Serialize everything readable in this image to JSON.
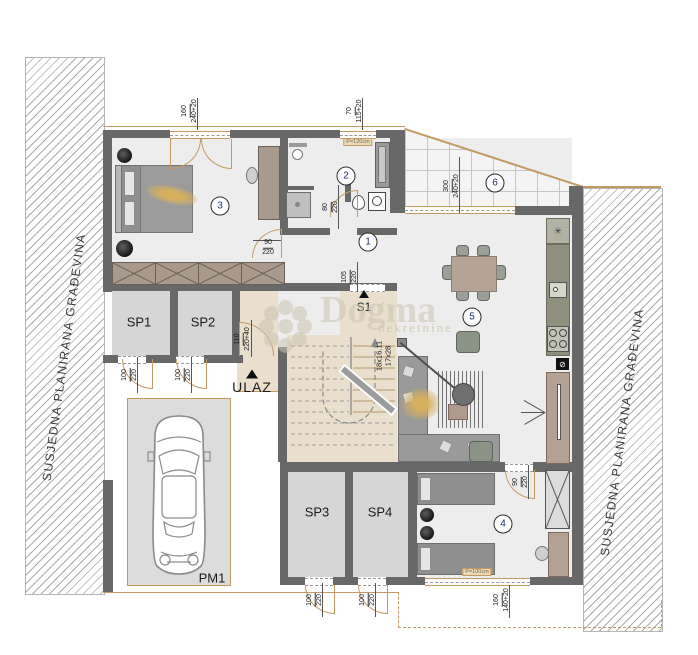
{
  "site": {
    "left_label": "SUSJEDNA PLANIRANA GRAĐEVINA",
    "right_label": "SUSJEDNA PLANIRANA GRAĐEVINA"
  },
  "watermark": {
    "brand": "Dogma",
    "tagline": "nekretnine"
  },
  "rooms": {
    "hall": "1",
    "bathroom": "2",
    "bedroom_a": "3",
    "bedroom_b": "4",
    "dining": "5",
    "terrace": "6"
  },
  "labels": {
    "sp1": "SP1",
    "sp2": "SP2",
    "sp3": "SP3",
    "sp4": "SP4",
    "pm1": "PM1",
    "entrance": "ULAZ",
    "stair": "S1",
    "stair_spec_1": "18x16.11",
    "stair_spec_2": "17x28"
  },
  "dims": {
    "bedroom_a_window": {
      "a": "160",
      "b": "240+20"
    },
    "bath_window": {
      "a": "70",
      "b": "115+20"
    },
    "terrace_opening": {
      "a": "300",
      "b": "240+20"
    },
    "bedroom_a_door": {
      "a": "90",
      "b": "220"
    },
    "bath_door": {
      "a": "80",
      "b": "220"
    },
    "s1_opening": {
      "a": "105",
      "b": "220"
    },
    "entry_door": {
      "a": "110",
      "b": "220+40"
    },
    "sp1_door": {
      "a": "100",
      "b": "220"
    },
    "sp2_door": {
      "a": "100",
      "b": "220"
    },
    "bedroom_b_door": {
      "a": "90",
      "b": "220"
    },
    "sp3_door": {
      "a": "100",
      "b": "220"
    },
    "sp4_door": {
      "a": "100",
      "b": "220"
    },
    "bedroom_b_window": {
      "a": "160",
      "b": "140+20"
    }
  },
  "parapets": {
    "bath": "P=120cm",
    "bedroom_b": "P=100cm"
  },
  "icons": {
    "fridge": "✳",
    "power": "⊘"
  },
  "colors": {
    "wall": "#686868",
    "door": "#c49a62",
    "floor": "#ededed",
    "service_floor": "#e9dfcc",
    "wood": "#a99a8e"
  }
}
